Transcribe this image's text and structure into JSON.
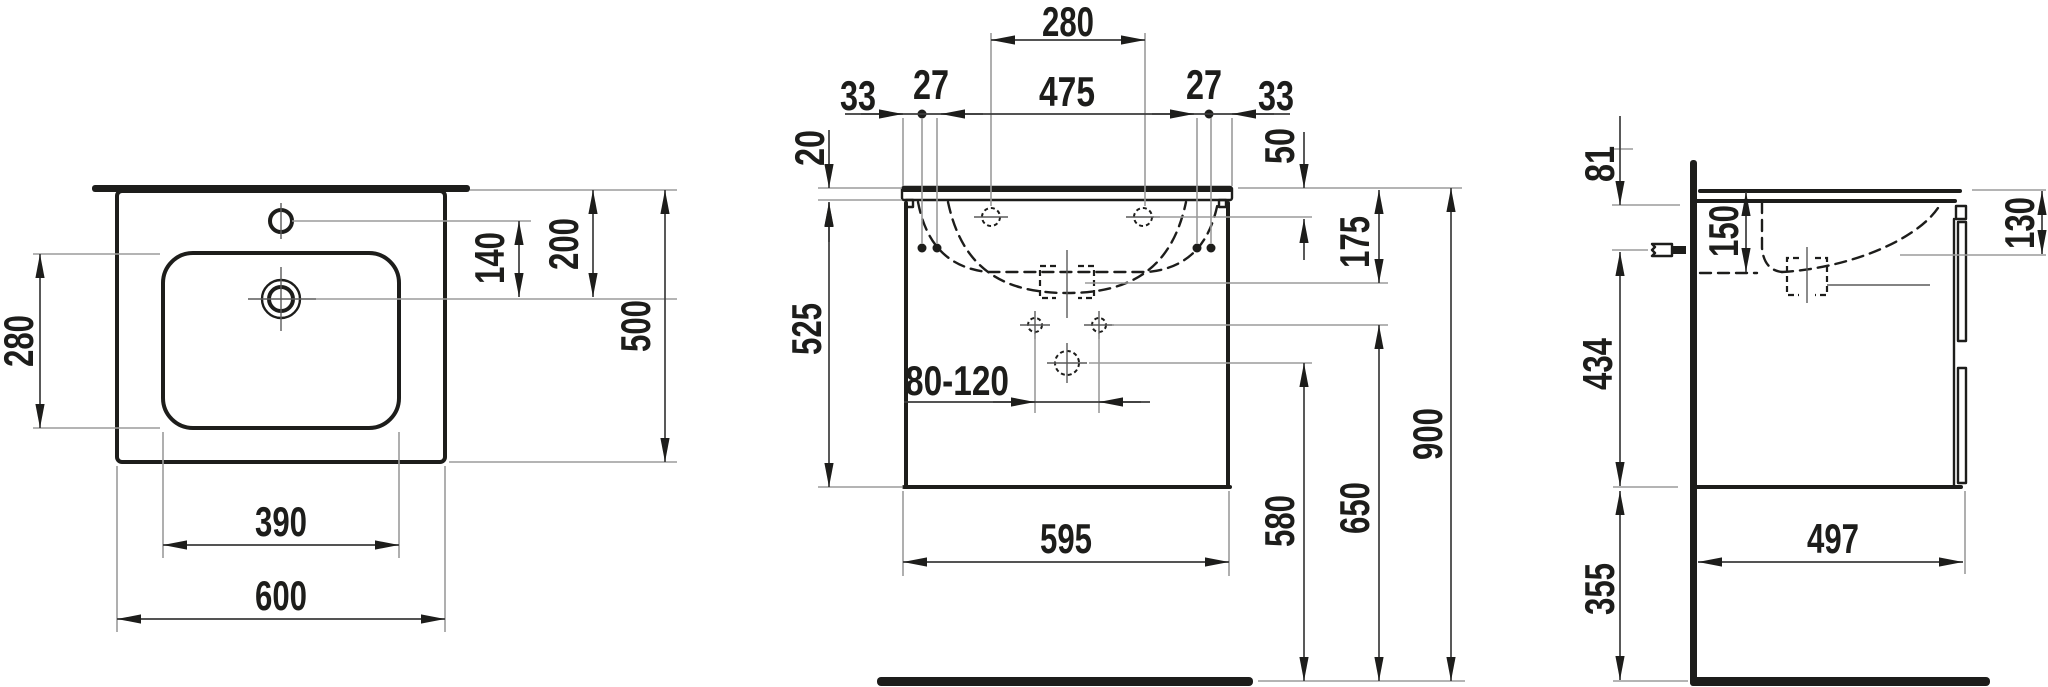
{
  "meta": {
    "drawing_type": "technical dimension drawing, washbasin with vanity unit",
    "background_color": "#ffffff",
    "line_color": "#1d1d1b",
    "unit": "mm"
  },
  "views": {
    "plan": {
      "name": "top view",
      "dims": {
        "basin_depth": "280",
        "tap_to_drain": "140",
        "edge_to_drain": "200",
        "overall_depth": "500",
        "basin_width": "390",
        "overall_width": "600"
      }
    },
    "front": {
      "name": "front view",
      "dims": {
        "tap_hole_centres": "280",
        "side_left": "33",
        "hole_offset_left": "27",
        "fixing_centres": "475",
        "hole_offset_right": "27",
        "side_right": "33",
        "holes_below_top": "50",
        "top_thickness": "20",
        "cabinet_height": "525",
        "siphon_below_top": "175",
        "drain_adjust": "80-120",
        "cabinet_width": "595",
        "drain_height": "580",
        "fixing_holes_height": "650",
        "rim_height": "900"
      }
    },
    "side": {
      "name": "side view",
      "dims": {
        "upper_fixing_offset": "81",
        "bowl_depth": "150",
        "apron_height": "130",
        "bracket_offset": "434",
        "floor_clearance": "355",
        "cabinet_depth": "497"
      }
    }
  }
}
